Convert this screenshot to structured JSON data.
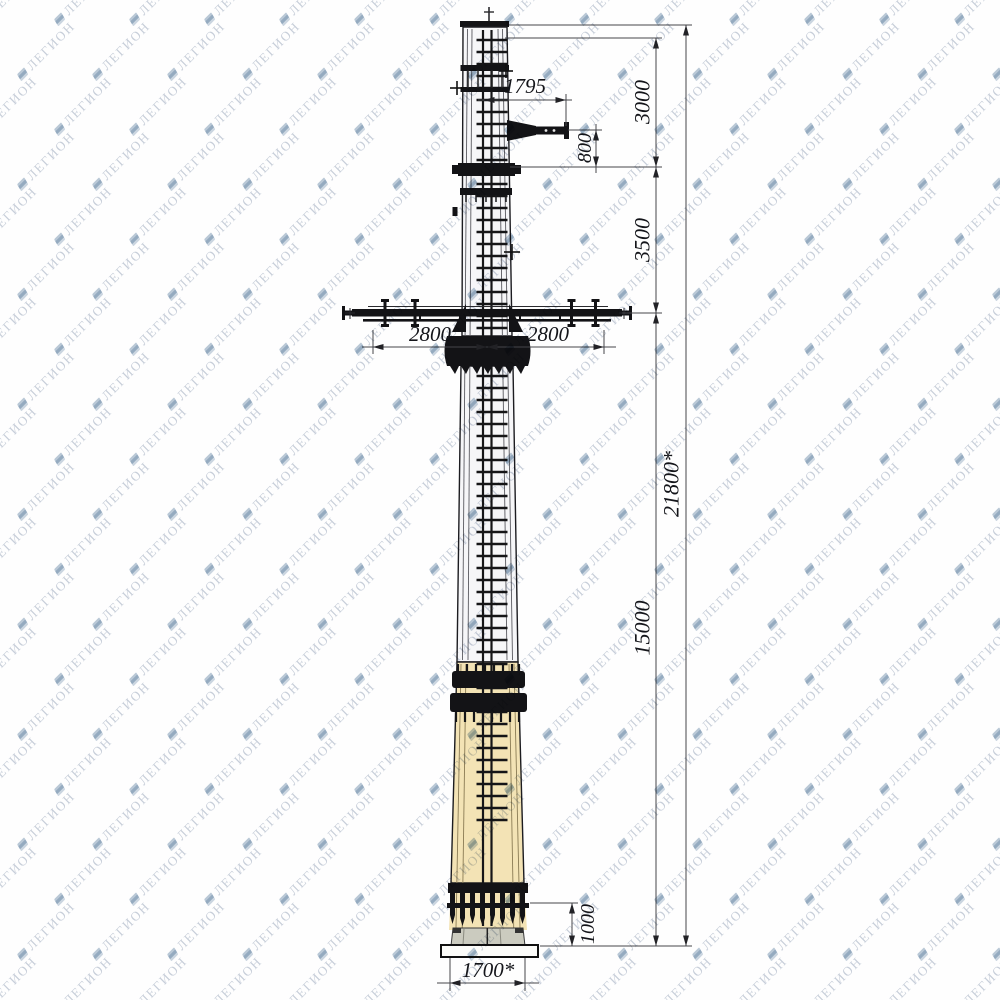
{
  "watermark": {
    "text": "ЛЕГИОН",
    "icon": "layers-logo-icon",
    "text_color": "#c2cad6",
    "icon_color": "#9db2c6"
  },
  "drawing": {
    "title": "Steel tubular power pole — elevation view",
    "type": "dimensioned technical drawing",
    "line_color": "#45464b",
    "pole_upper_fill": "#f6f6f8",
    "pole_lower_fill": "#f3e3b5",
    "pedestal_fill": "#cbcbbf",
    "base_plate_fill": "#fcfcf9",
    "dimensions": [
      {
        "id": "arm-offset",
        "value": "1795",
        "orientation": "horizontal"
      },
      {
        "id": "top-section",
        "value": "3000",
        "orientation": "vertical"
      },
      {
        "id": "arm-drop",
        "value": "800",
        "orientation": "vertical"
      },
      {
        "id": "upper-mid-section",
        "value": "3500",
        "orientation": "vertical"
      },
      {
        "id": "crossarm-left",
        "value": "2800",
        "orientation": "horizontal"
      },
      {
        "id": "crossarm-right",
        "value": "2800",
        "orientation": "horizontal"
      },
      {
        "id": "total-height",
        "value": "21800*",
        "orientation": "vertical"
      },
      {
        "id": "lower-section",
        "value": "15000",
        "orientation": "vertical"
      },
      {
        "id": "base-section",
        "value": "1000",
        "orientation": "vertical"
      },
      {
        "id": "base-width",
        "value": "1700*",
        "orientation": "horizontal"
      }
    ]
  }
}
